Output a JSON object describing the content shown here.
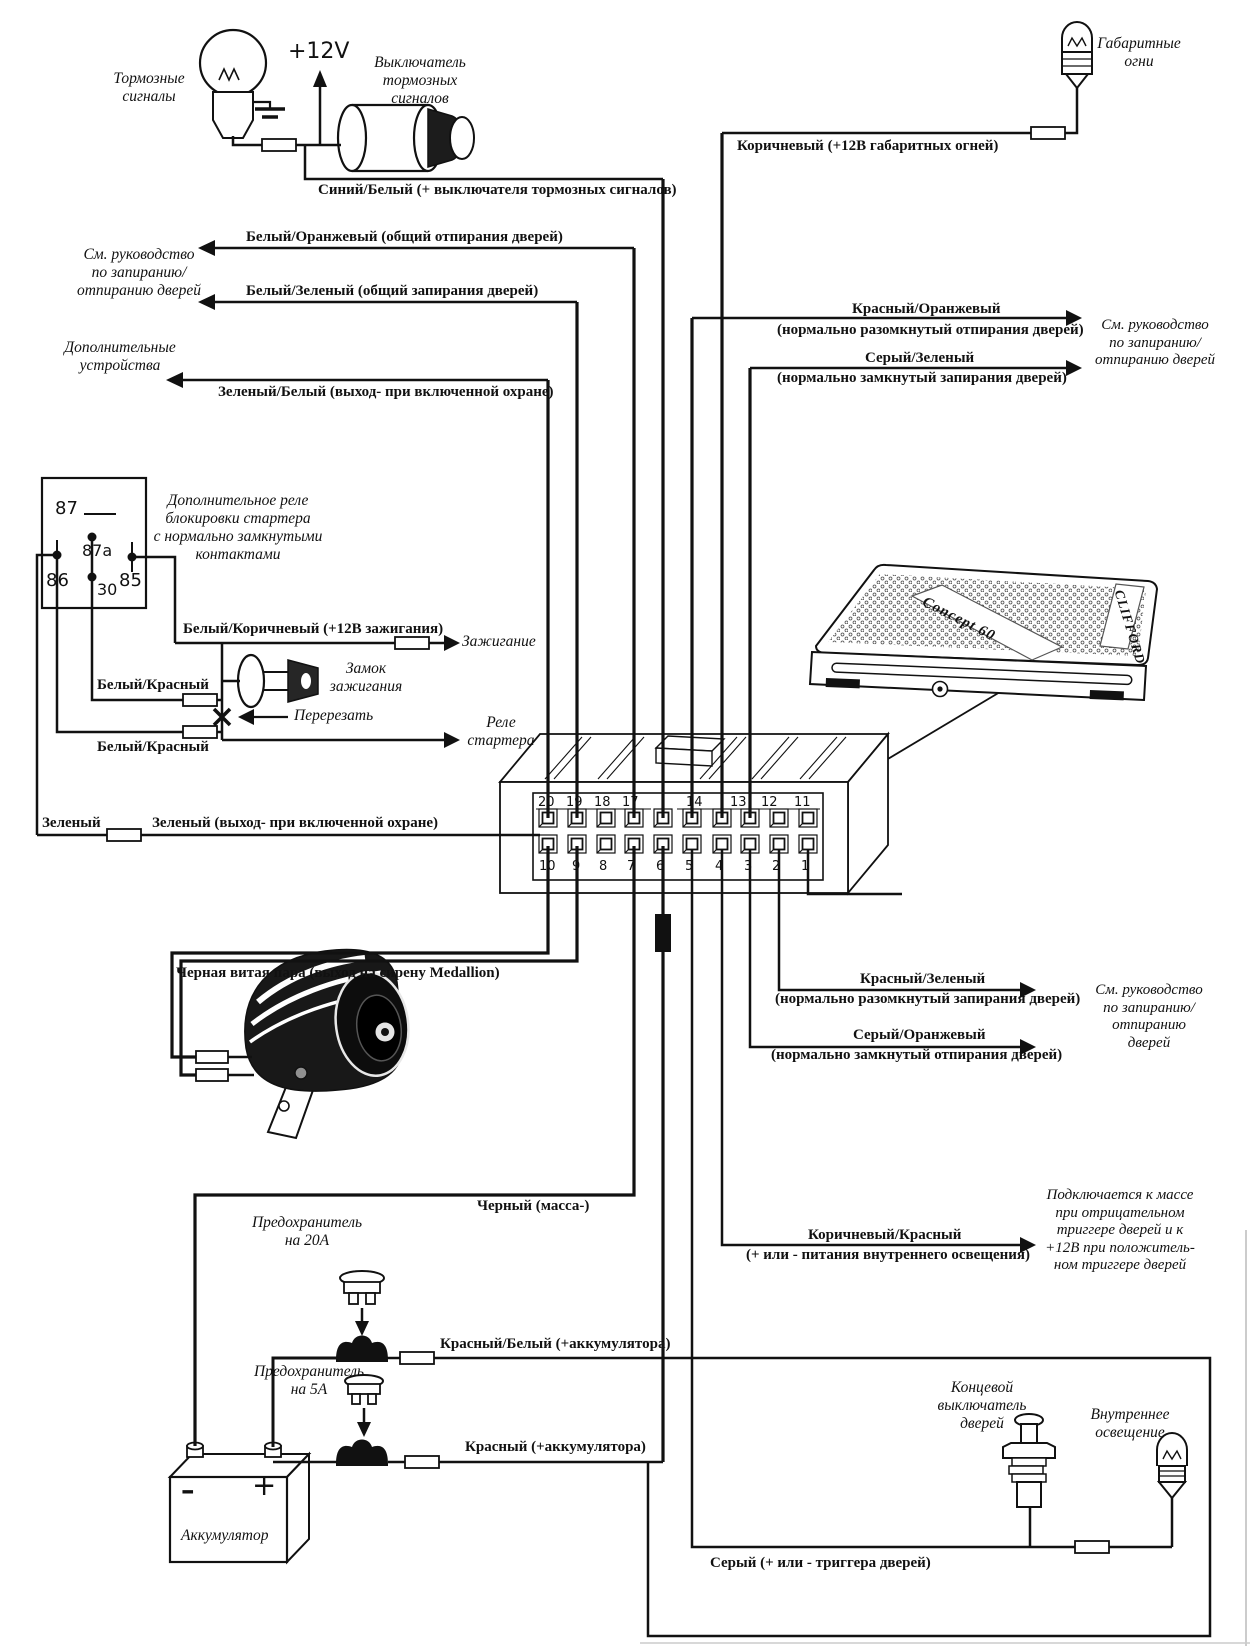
{
  "labels": {
    "brake_lamp": "Тормозные\nсигналы",
    "plus_12v": "+12V",
    "brake_switch": "Выключатель\nтормозных\nсигналов",
    "blue_white": "Синий/Белый (+ выключателя тормоз­ных сигналов)",
    "white_orange": "Белый/Оранжевый (общий отпирания дверей)",
    "see_manual_left": "См. руководство\nпо запиранию/\nотпиранию дверей",
    "white_green": "Белый/Зеленый (общий запирания дверей)",
    "aux": "Дополнительные\nустройства",
    "green_white": "Зеленый/Белый (выход- при включенной охране)",
    "white_brown": "Белый/Коричневый (+12В зажигания)",
    "ignition": "Зажигание",
    "lock": "Замок\nзажигания",
    "white_red_1": "Белый/Красный",
    "cut": "Перерезать",
    "white_red_2": "Белый/Красный",
    "starter_relay": "Реле\nстартера",
    "green": "Зеленый",
    "green_out": "Зеленый (выход- при включенной охране)",
    "twisted_pair": "Черная витая пара (выход на сирену Medallion)",
    "parking_lights": "Габаритные\nогни",
    "brown": "Коричневый (+12В габаритных огней)",
    "red_orange": "Красный/Оранжевый",
    "red_orange_sub": "(нормально разомкнутый отпирания дверей)",
    "see_manual_right_top": "См. руководство\nпо запиранию/\nотпиранию дверей",
    "gray_green": "Серый/Зеленый",
    "gray_green_sub": "(нормально замкнутый запирания дверей)",
    "red_green": "Красный/Зеленый",
    "red_green_sub": "(нормально разомкнутый запирания дверей)",
    "see_manual_right_mid": "См. руководство\nпо запиранию/\nотпиранию\nдверей",
    "gray_orange": "Серый/Оранжевый",
    "gray_orange_sub": "(нормально замкнутый отпирания дверей)",
    "black": "Черный (масса-)",
    "brown_red": "Коричневый/Красный",
    "brown_red_sub": "(+ или - питания внутреннего освещения)",
    "trigger_note": "Подключается к массе\nпри отрицательном\nтриггере дверей и к\n+12В при положитель-\nном триггере дверей",
    "fuse20": "Предохранитель\nна 20А",
    "red_white": "Красный/Белый (+аккумулятора)",
    "fuse5": "Предохранитель\nна 5А",
    "red": "Красный (+аккумулятора)",
    "battery": "Аккумулятор",
    "minus": "–",
    "plus": "+",
    "door_switch": "Концевой\nвыключатель\nдверей",
    "interior_light": "Внутреннее\nосвещение",
    "gray": "Серый (+ или - триггера дверей)"
  },
  "relay": {
    "note": "Дополнительное реле\nблокировки стартера\nс нормально замкнутыми\nконтактами",
    "pin87": "87",
    "pin87a": "87a",
    "pin86": "86",
    "pin85": "85",
    "pin30": "30"
  },
  "connector": {
    "top": [
      "20",
      "19",
      "18",
      "17",
      "14",
      "13",
      "12",
      "11"
    ],
    "bottom": [
      "10",
      "9",
      "8",
      "7",
      "6",
      "5",
      "4",
      "3",
      "2",
      "1"
    ]
  },
  "unit": {
    "brand": "CLIFFORD",
    "model": "Concept 60"
  },
  "colors": {
    "ink": "#111111",
    "paper": "#ffffff"
  }
}
